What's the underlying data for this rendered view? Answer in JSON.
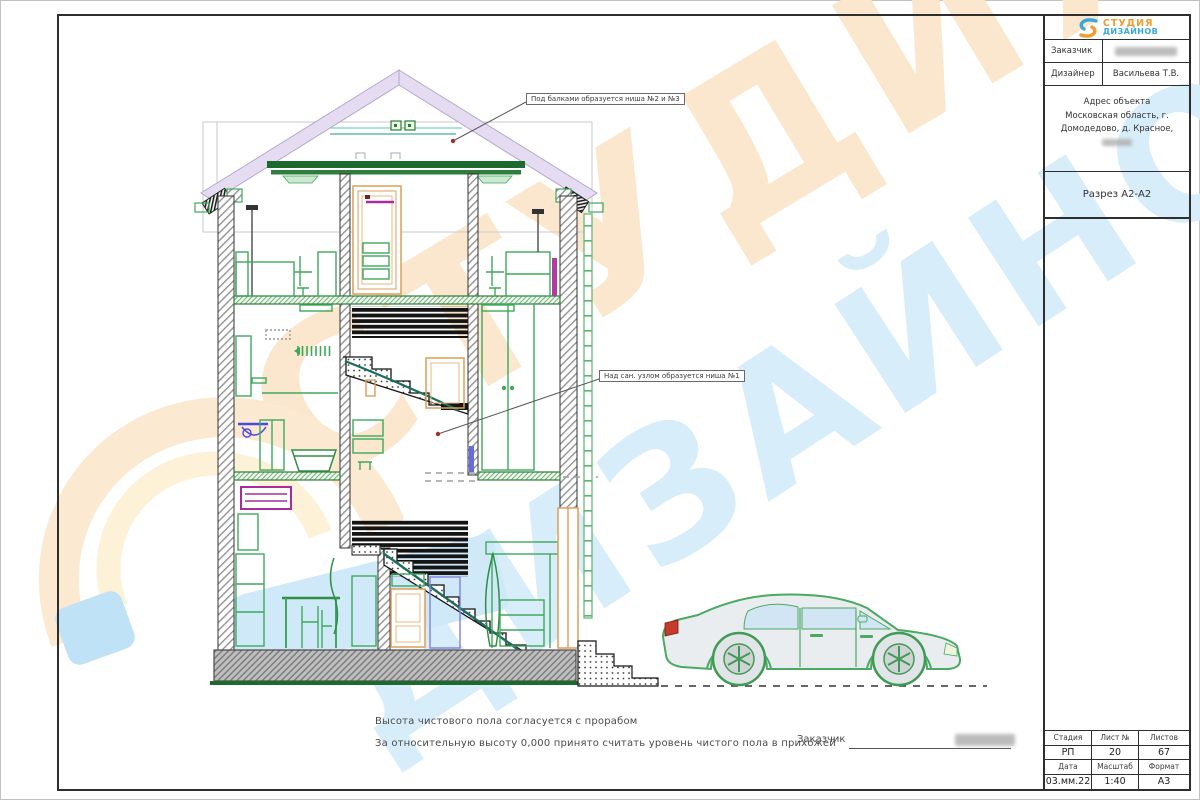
{
  "logo": {
    "word1": "СТУДИЯ",
    "word2": "ДИЗАЙНОВ"
  },
  "title_block": {
    "client_label": "Заказчик",
    "designer_label": "Дизайнер",
    "designer_value": "Васильева Т.В.",
    "address_line1": "Адрес объекта",
    "address_line2": "Московская область, г.",
    "address_line3": "Домодедово, д. Красное,",
    "section_title": "Разрез А2-А2"
  },
  "info_table": {
    "stage_label": "Стадия",
    "sheet_label": "Лист №",
    "sheets_label": "Листов",
    "stage_value": "РП",
    "sheet_value": "20",
    "sheets_value": "67",
    "date_label": "Дата",
    "scale_label": "Масштаб",
    "format_label": "Формат",
    "date_value": "03.мм.22",
    "scale_value": "1:40",
    "format_value": "А3"
  },
  "notes": {
    "line1": "Высота чистового пола согласуется с прорабом",
    "line2": "За относительную высоту 0,000 принято считать уровень чистого пола в прихожей"
  },
  "signature": {
    "label": "Заказчик"
  },
  "annotations": {
    "niche23": "Под балками образуется ниша №2 и №3",
    "niche1": "Над сан. узлом образуется ниша №1"
  },
  "watermark": {
    "word1": "СТУДИЯ",
    "word2": "ДИЗАЙНОВ"
  },
  "colors": {
    "roof_lavender": "#e6dcf2",
    "beam_green": "#1d6a2f",
    "furniture_green": "#3fa85c",
    "teal": "#46ae9e",
    "door_orange": "#dc9e58",
    "magenta": "#a82ca0",
    "fixture_blue": "#4a4ae0",
    "foundation_gray": "#bfbfbf",
    "car_green": "#4aa962",
    "watermark_peach": "#fbe7cd",
    "watermark_blue": "#d7edfa",
    "logo_orange": "#f09c2e",
    "logo_blue": "#3aa8d8"
  }
}
